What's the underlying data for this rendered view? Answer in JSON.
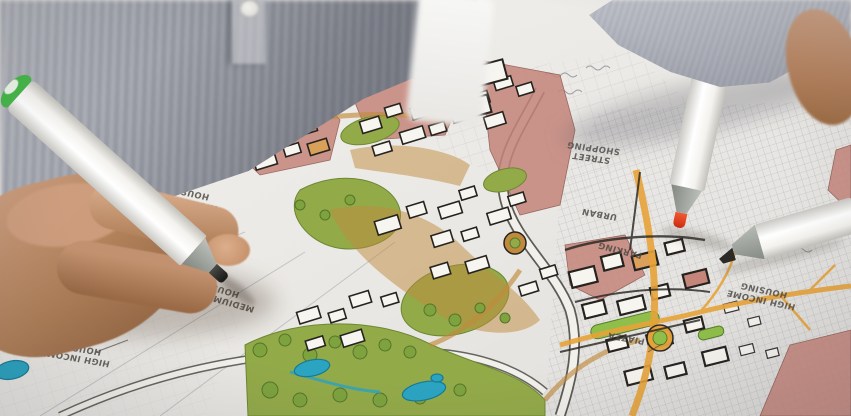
{
  "scene": {
    "description": "Photograph: hands marking up a hand-drawn, partly colored urban-planning masterplan with felt-tip markers"
  },
  "map": {
    "labels": [
      {
        "line1": "HIGH INCOME",
        "line2": "HOUSING"
      },
      {
        "line1": "MEDIUM INCOME",
        "line2": "HOUSING"
      },
      {
        "line1": "HIGH INCOME",
        "line2": "HOUSING"
      },
      {
        "line1": "STREET",
        "line2": "SHOPPING"
      },
      {
        "line1": "URBAN",
        "line2": ""
      },
      {
        "line1": "PARKING",
        "line2": ""
      },
      {
        "line1": "PIAZZA",
        "line2": ""
      },
      {
        "line1": "HIGH INCOME",
        "line2": "HOUSING"
      }
    ]
  },
  "markers": {
    "held": {
      "name": "white marker with green cap, black tip",
      "cap_color": "#46b649",
      "tip_color": "#2b2a27"
    },
    "red": {
      "name": "white marker with red-orange tip",
      "tip_color": "#e0391c"
    },
    "black": {
      "name": "white marker with black chisel tip",
      "tip_color": "#2b2a27"
    }
  },
  "palette": {
    "paper": "#eae8e4",
    "sketch_gray": "#a9aeb6",
    "park_green": "#93aa49",
    "tree_green": "#6d8a35",
    "plaza_tan": "#c08a3e",
    "block_pink": "#c5857b",
    "building_white": "#f7f5f0",
    "outline_black": "#26231f",
    "water_blue": "#2ba4c2",
    "street_orange": "#e7a33a",
    "shirt_gray": "#8d919b",
    "sweater_gray": "#9b9fab",
    "skin": "#b98a6a"
  }
}
